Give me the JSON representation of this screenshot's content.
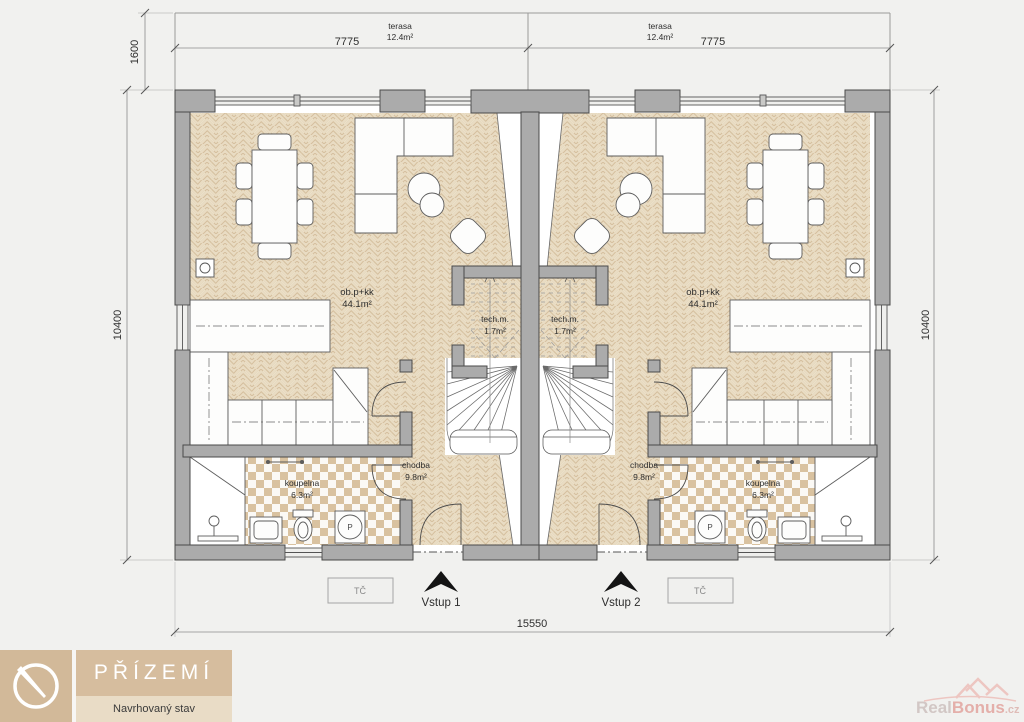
{
  "colors": {
    "background": "#f1f1ef",
    "wall": "#ababab",
    "wall_outline": "#4a4a4a",
    "parquet_base": "#e9dcc3",
    "parquet_line": "#d5bf9e",
    "tile": "#d9c2a0",
    "title_tan": "#d6bd9e",
    "title_tan_light": "#e9dcc6",
    "watermark_pink": "#e2a49e",
    "arrow_black": "#141414"
  },
  "dimensions": {
    "terrace_depth": "1600",
    "unit_width_left": "7775",
    "unit_width_right": "7775",
    "height_left": "10400",
    "height_right": "10400",
    "total_width": "15550"
  },
  "terrace": {
    "label": "terasa",
    "area": "12.4m²"
  },
  "rooms": {
    "living": {
      "label": "ob.p+kk",
      "area": "44.1m²"
    },
    "tech": {
      "label": "tech.m.",
      "area": "1.7m²"
    },
    "hall": {
      "label": "chodba",
      "area": "9.8m²"
    },
    "bath": {
      "label": "koupelna",
      "area": "6.3m²"
    }
  },
  "equipment": {
    "heat_pump": "TČ",
    "washer": "P"
  },
  "entrances": {
    "entrance1": "Vstup 1",
    "entrance2": "Vstup 2"
  },
  "title_block": {
    "floor": "PŘÍZEMÍ",
    "status": "Navrhovaný stav"
  },
  "watermark": {
    "part1": "Real",
    "part2": "Bonus",
    "suffix": ".cz"
  }
}
